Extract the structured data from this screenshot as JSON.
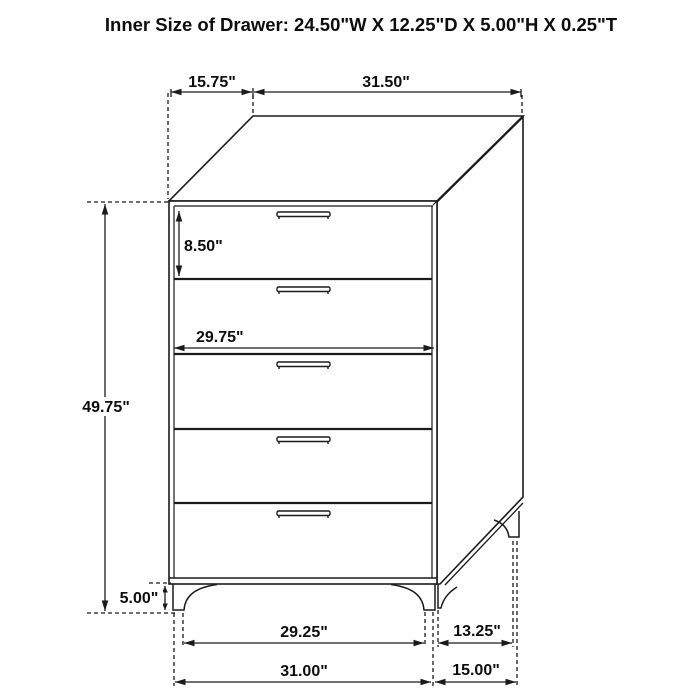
{
  "title": "Inner Size of Drawer: 24.50\"W X 12.25\"D X 5.00\"H X 0.25\"T",
  "colors": {
    "line": "#1b1b1b",
    "background": "#ffffff",
    "text": "#0d0d0d"
  },
  "diagram": {
    "type": "furniture-dimension-drawing",
    "subject": "5-drawer chest",
    "drawer_count": 5
  },
  "dimensions": {
    "top_depth": "15.75\"",
    "top_width": "31.50\"",
    "drawer_front_height": "8.50\"",
    "drawer_front_width": "29.75\"",
    "overall_height": "49.75\"",
    "leg_height": "5.00\"",
    "base_span_front": "29.25\"",
    "base_span_side": "13.25\"",
    "base_width": "31.00\"",
    "base_depth": "15.00\""
  }
}
